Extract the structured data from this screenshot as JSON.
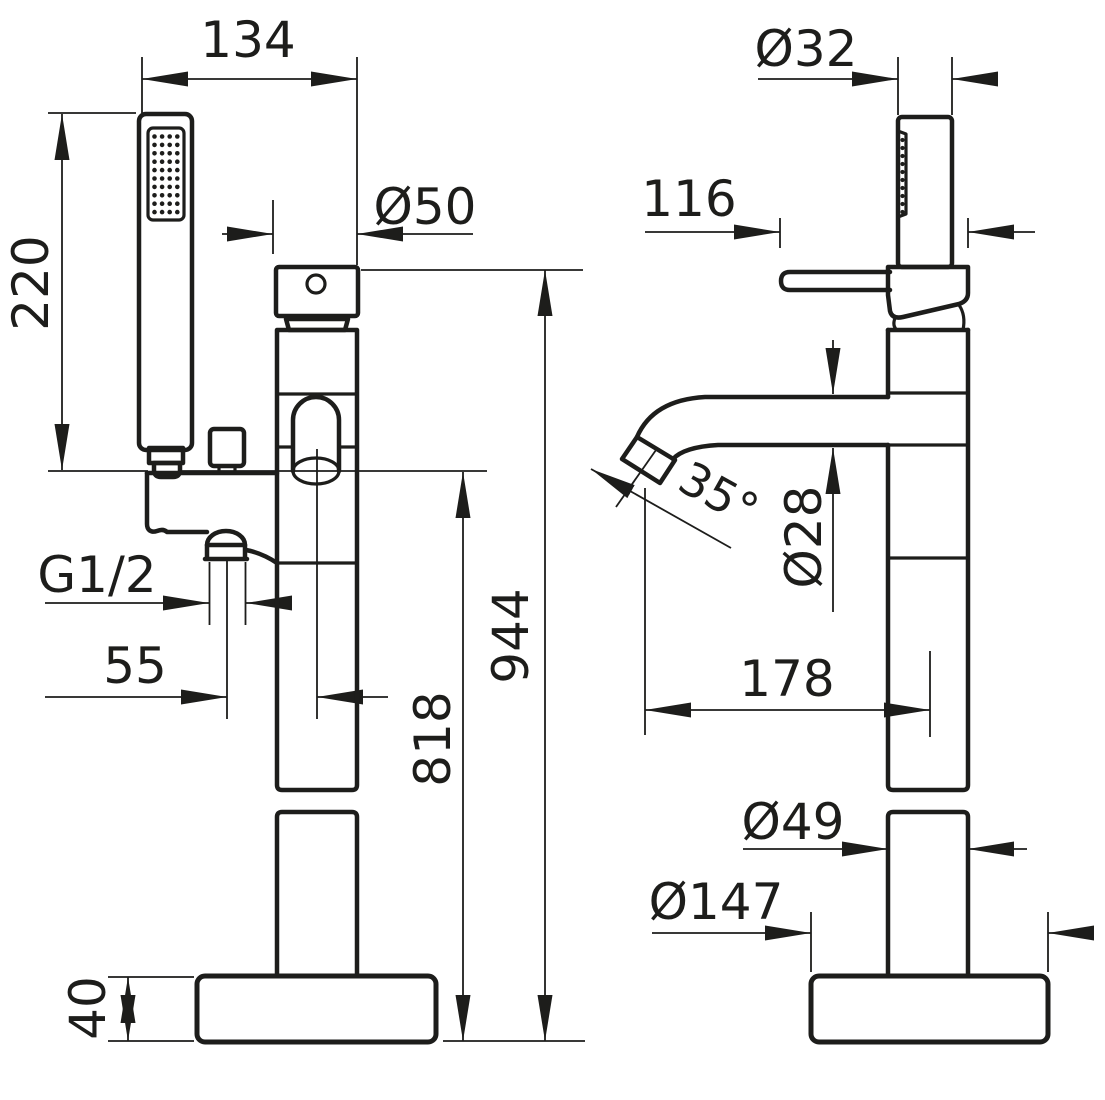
{
  "page": {
    "background": "#ffffff",
    "line_color": "#1d1d1b",
    "description": "Technical dimension drawing of freestanding bathtub mixer with hand shower, front and side views"
  },
  "front_view": {
    "dims": {
      "overall_width": "134",
      "handset_height": "220",
      "head_diameter": "Ø50",
      "inlet_thread": "G1/2",
      "inlet_offset": "55",
      "spout_height": "818",
      "total_height": "944",
      "base_height": "40"
    }
  },
  "side_view": {
    "dims": {
      "handset_diameter": "Ø32",
      "lever_length": "116",
      "spout_angle": "35°",
      "spout_diameter": "Ø28",
      "spout_reach": "178",
      "column_diameter": "Ø49",
      "base_diameter": "Ø147"
    }
  }
}
